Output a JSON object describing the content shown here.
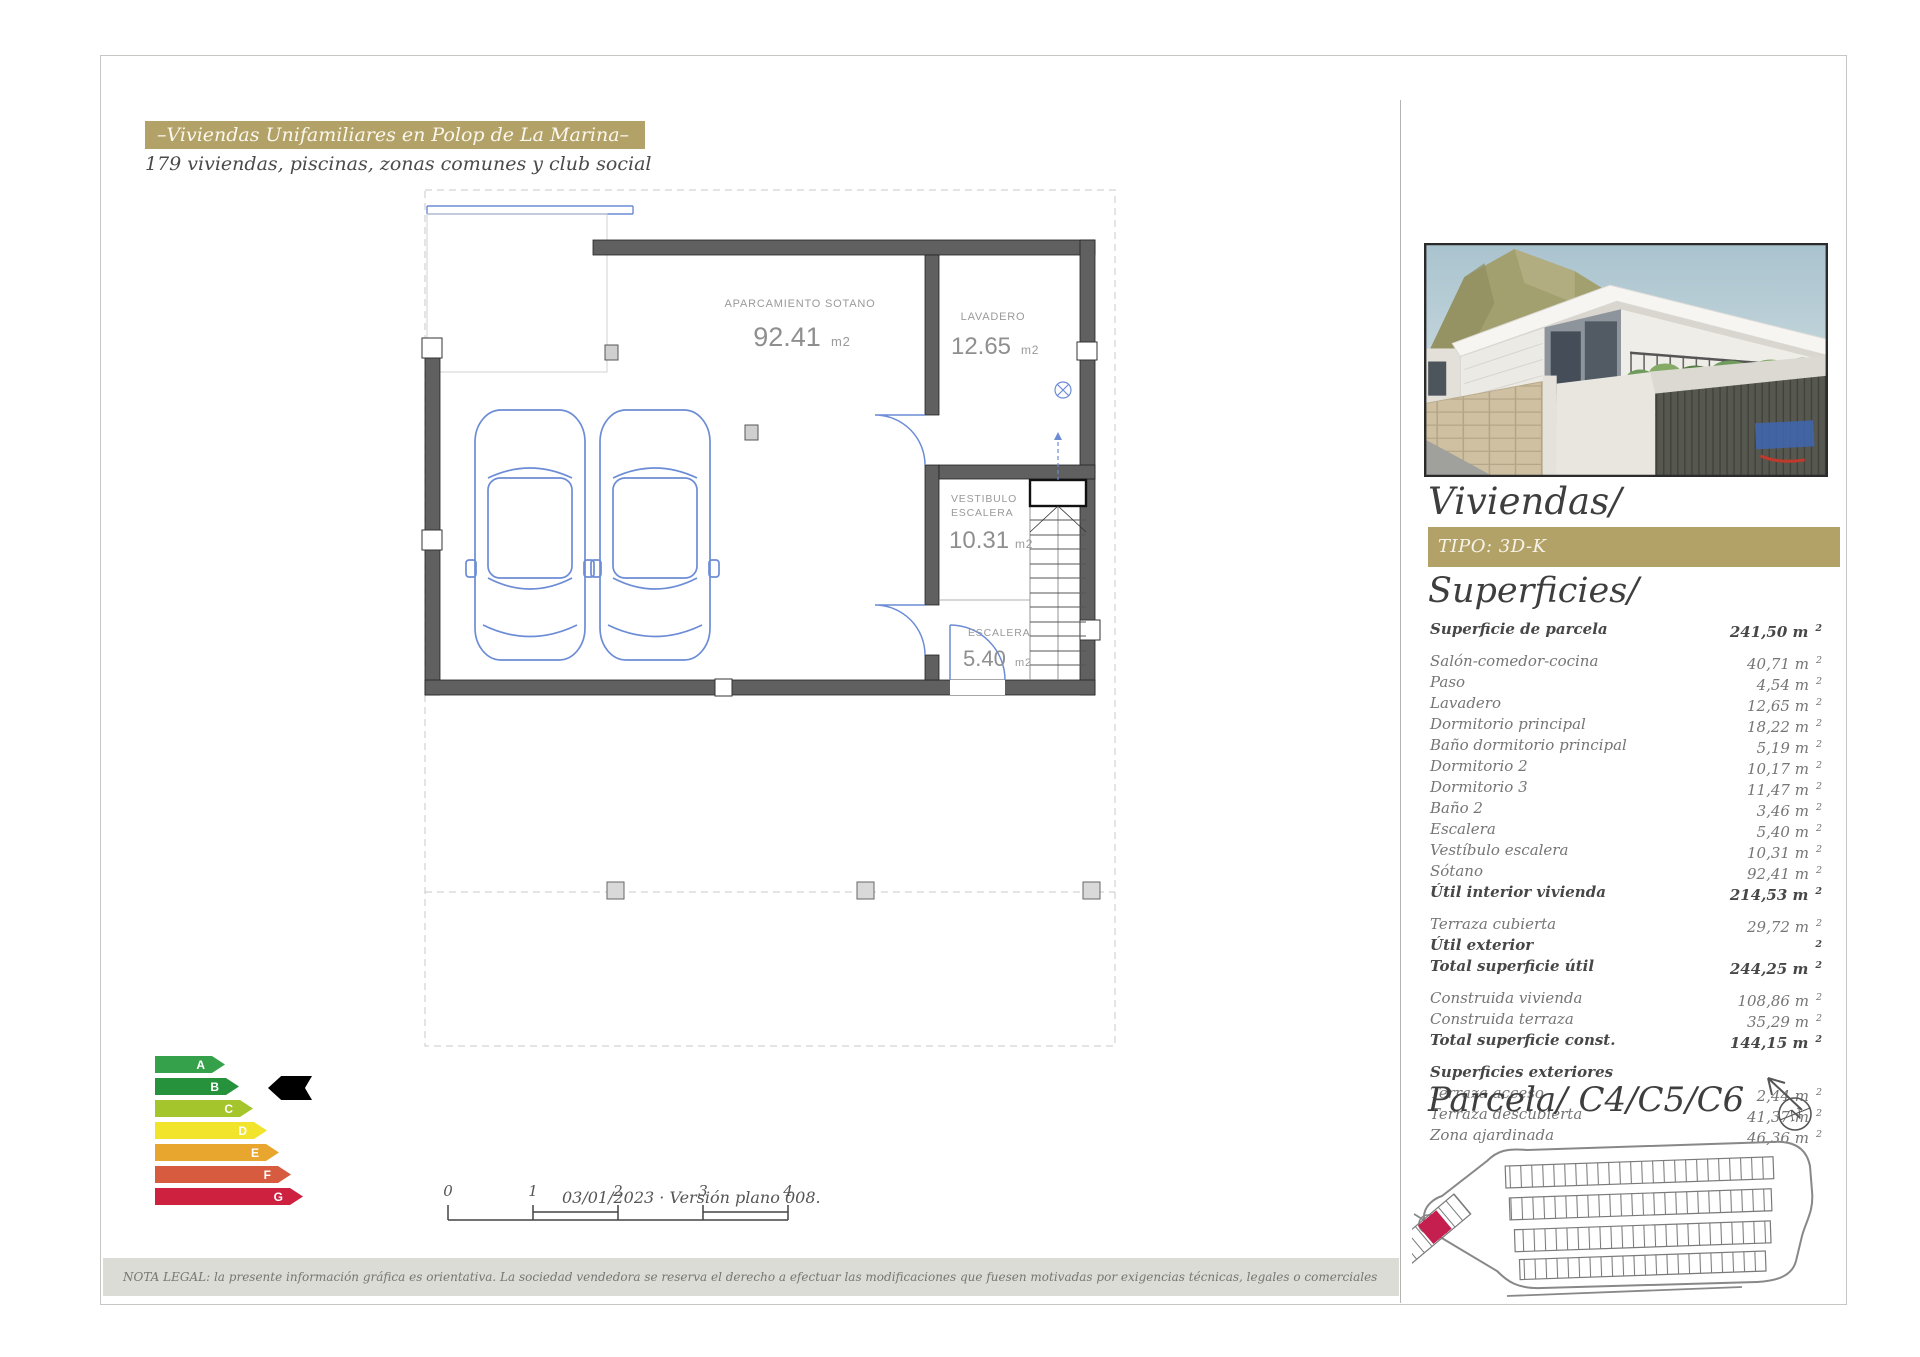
{
  "header": {
    "banner": "–Viviendas Unifamiliares en Polop de La Marina–",
    "subtitle": "179 viviendas, piscinas, zonas comunes y club social"
  },
  "plan": {
    "rooms": {
      "garage": {
        "name": "APARCAMIENTO SOTANO",
        "area": "92.41",
        "unit": "m2"
      },
      "laundry": {
        "name": "LAVADERO",
        "area": "12.65",
        "unit": "m2"
      },
      "hall": {
        "name_line1": "VESTIBULO",
        "name_line2": "ESCALERA",
        "area": "10.31",
        "unit": "m2"
      },
      "stairs": {
        "name": "ESCALERA",
        "area": "5.40",
        "unit": "m2"
      }
    },
    "scale_ticks": [
      "0",
      "1",
      "2",
      "3",
      "4"
    ],
    "version_note": "03/01/2023 · Versión plano 008."
  },
  "energy": {
    "grades": [
      {
        "letter": "A",
        "color": "#35a14b",
        "width": 70
      },
      {
        "letter": "B",
        "color": "#27923c",
        "width": 84
      },
      {
        "letter": "C",
        "color": "#a4c52b",
        "width": 98
      },
      {
        "letter": "D",
        "color": "#f2e32b",
        "width": 112
      },
      {
        "letter": "E",
        "color": "#e9a62f",
        "width": 124
      },
      {
        "letter": "F",
        "color": "#d75b3f",
        "width": 136
      },
      {
        "letter": "G",
        "color": "#ce2140",
        "width": 148
      }
    ],
    "indicator_grade": "B"
  },
  "sidebar": {
    "title": "Viviendas/",
    "tipo": "TIPO: 3D-K",
    "superficies_title": "Superficies/",
    "unit": "m",
    "unit_sup": "2",
    "rows": [
      {
        "label": "Superficie de parcela",
        "value": "241,50",
        "bold": true,
        "gap": true
      },
      {
        "label": "Salón-comedor-cocina",
        "value": "40,71"
      },
      {
        "label": "Paso",
        "value": "4,54"
      },
      {
        "label": "Lavadero",
        "value": "12,65"
      },
      {
        "label": "Dormitorio principal",
        "value": "18,22"
      },
      {
        "label": "Baño dormitorio principal",
        "value": "5,19"
      },
      {
        "label": "Dormitorio 2",
        "value": "10,17"
      },
      {
        "label": "Dormitorio 3",
        "value": "11,47"
      },
      {
        "label": "Baño 2",
        "value": "3,46"
      },
      {
        "label": "Escalera",
        "value": "5,40"
      },
      {
        "label": "Vestíbulo escalera",
        "value": "10,31"
      },
      {
        "label": "Sótano",
        "value": "92,41"
      },
      {
        "label": "Útil interior vivienda",
        "value": "214,53",
        "bold": true,
        "gap": true
      },
      {
        "label": "Terraza cubierta",
        "value": "29,72"
      },
      {
        "label": "Útil exterior",
        "value": "",
        "bold": true
      },
      {
        "label": "Total superficie útil",
        "value": "244,25",
        "bold": true,
        "gap": true
      },
      {
        "label": "Construida vivienda",
        "value": "108,86"
      },
      {
        "label": "Construida terraza",
        "value": "35,29"
      },
      {
        "label": "Total superficie const.",
        "value": "144,15",
        "bold": true,
        "gap": true
      },
      {
        "label": "Superficies exteriores",
        "header": true,
        "bold": true
      },
      {
        "label": "Terraza acceso",
        "value": "2,44"
      },
      {
        "label": "Terraza descubierta",
        "value": "41,37"
      },
      {
        "label": "Zona ajardinada",
        "value": "46,36"
      }
    ],
    "parcela_title": "Parcela/ C4/C5/C6",
    "compass_letter": "N"
  },
  "legal": "NOTA LEGAL: la presente información gráfica es orientativa. La sociedad vendedora se reserva el derecho a efectuar las modificaciones que fuesen motivadas por exigencias técnicas, legales o comerciales",
  "colors": {
    "gold": "#b3a267",
    "plan_blue": "#6c8cd6",
    "wall_gray": "#606060",
    "parcel_red": "#c41f4e"
  }
}
